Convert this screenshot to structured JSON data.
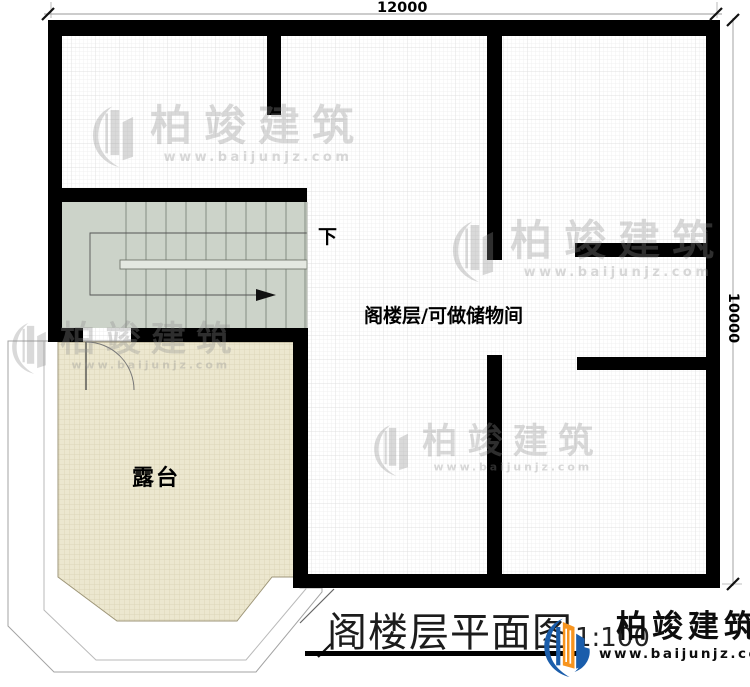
{
  "plan": {
    "dim_top": "12000",
    "dim_right": "10000",
    "label_down": "下",
    "label_attic": "阁楼层/可做储物间",
    "label_terrace": "露台"
  },
  "title_block": {
    "title": "阁楼层平面图",
    "scale": "1:100"
  },
  "brand": {
    "name": "柏竣建筑",
    "website": "www.baijunjz.com"
  },
  "colors": {
    "wall": "#000000",
    "stairs_fill": "#ccd3c9",
    "terrace_fill": "#ece7cf",
    "logo_blue": "#1a5dab",
    "logo_orange": "#f7941e"
  }
}
